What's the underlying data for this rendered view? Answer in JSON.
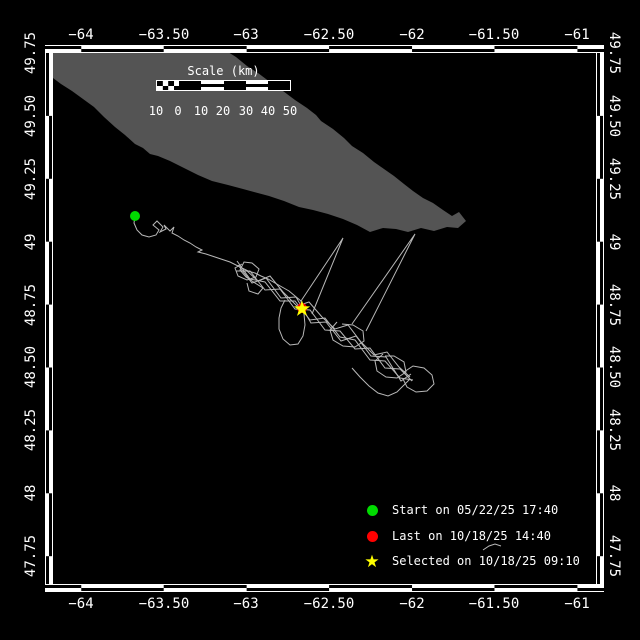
{
  "axes": {
    "top": [
      {
        "label": "−64",
        "x": 81
      },
      {
        "label": "−63.50",
        "x": 164
      },
      {
        "label": "−63",
        "x": 246
      },
      {
        "label": "−62.50",
        "x": 329
      },
      {
        "label": "−62",
        "x": 412
      },
      {
        "label": "−61.50",
        "x": 494
      },
      {
        "label": "−61",
        "x": 577
      }
    ],
    "bottom": [
      {
        "label": "−64",
        "x": 81
      },
      {
        "label": "−63.50",
        "x": 164
      },
      {
        "label": "−63",
        "x": 246
      },
      {
        "label": "−62.50",
        "x": 329
      },
      {
        "label": "−62",
        "x": 412
      },
      {
        "label": "−61.50",
        "x": 494
      },
      {
        "label": "−61",
        "x": 577
      }
    ],
    "left": [
      {
        "label": "49.75",
        "y": 53
      },
      {
        "label": "49.50",
        "y": 116
      },
      {
        "label": "49.25",
        "y": 179
      },
      {
        "label": "49",
        "y": 242
      },
      {
        "label": "48.75",
        "y": 305
      },
      {
        "label": "48.50",
        "y": 367
      },
      {
        "label": "48.25",
        "y": 430
      },
      {
        "label": "48",
        "y": 493
      },
      {
        "label": "47.75",
        "y": 556
      }
    ],
    "right": [
      {
        "label": "49.75",
        "y": 53
      },
      {
        "label": "49.50",
        "y": 116
      },
      {
        "label": "49.25",
        "y": 179
      },
      {
        "label": "49",
        "y": 242
      },
      {
        "label": "48.75",
        "y": 305
      },
      {
        "label": "48.50",
        "y": 367
      },
      {
        "label": "48.25",
        "y": 430
      },
      {
        "label": "48",
        "y": 493
      },
      {
        "label": "47.75",
        "y": 556
      }
    ]
  },
  "scale_bar": {
    "title": "Scale (km)",
    "labels": [
      {
        "label": "10",
        "x": 156
      },
      {
        "label": "0",
        "x": 178
      },
      {
        "label": "10",
        "x": 201
      },
      {
        "label": "20",
        "x": 223
      },
      {
        "label": "30",
        "x": 246
      },
      {
        "label": "40",
        "x": 268
      },
      {
        "label": "50",
        "x": 290
      }
    ]
  },
  "legend": {
    "items": [
      {
        "marker": "green-dot",
        "color": "#00db00",
        "label": "Start on 05/22/25 17:40",
        "y": 510
      },
      {
        "marker": "red-dot",
        "color": "#ff0000",
        "label": "Last on 10/18/25 14:40",
        "y": 536
      },
      {
        "marker": "yellow-star",
        "color": "#ffff00",
        "label": "Selected on 10/18/25 09:10",
        "y": 561
      }
    ]
  },
  "colors": {
    "background": "#000000",
    "frame": "#ffffff",
    "land": "#545454",
    "track": "#b8b8b8",
    "start": "#00db00",
    "last": "#ff0000",
    "selected": "#ffff00"
  },
  "map": {
    "island": {
      "points": [
        [
          53,
          52
        ],
        [
          228,
          52
        ],
        [
          236,
          57
        ],
        [
          247,
          66
        ],
        [
          258,
          73
        ],
        [
          270,
          82
        ],
        [
          283,
          91
        ],
        [
          295,
          100
        ],
        [
          307,
          108
        ],
        [
          316,
          115
        ],
        [
          321,
          121
        ],
        [
          333,
          129
        ],
        [
          344,
          138
        ],
        [
          352,
          146
        ],
        [
          363,
          153
        ],
        [
          374,
          162
        ],
        [
          384,
          169
        ],
        [
          394,
          176
        ],
        [
          404,
          184
        ],
        [
          413,
          191
        ],
        [
          423,
          198
        ],
        [
          433,
          203
        ],
        [
          443,
          210
        ],
        [
          452,
          216
        ],
        [
          459,
          212
        ],
        [
          466,
          221
        ],
        [
          458,
          228
        ],
        [
          447,
          227
        ],
        [
          434,
          231
        ],
        [
          421,
          228
        ],
        [
          408,
          232
        ],
        [
          396,
          229
        ],
        [
          383,
          228
        ],
        [
          370,
          232
        ],
        [
          357,
          225
        ],
        [
          343,
          219
        ],
        [
          328,
          214
        ],
        [
          313,
          210
        ],
        [
          299,
          207
        ],
        [
          284,
          201
        ],
        [
          269,
          196
        ],
        [
          254,
          192
        ],
        [
          243,
          189
        ],
        [
          228,
          185
        ],
        [
          212,
          181
        ],
        [
          198,
          175
        ],
        [
          184,
          168
        ],
        [
          170,
          161
        ],
        [
          158,
          156
        ],
        [
          150,
          154
        ],
        [
          143,
          148
        ],
        [
          135,
          144
        ],
        [
          125,
          135
        ],
        [
          115,
          127
        ],
        [
          104,
          117
        ],
        [
          94,
          107
        ],
        [
          83,
          99
        ],
        [
          72,
          91
        ],
        [
          61,
          84
        ],
        [
          53,
          78
        ]
      ]
    },
    "track": {
      "segments": [
        [
          [
            135,
            216
          ],
          [
            134,
            223
          ],
          [
            137,
            230
          ],
          [
            142,
            235
          ],
          [
            149,
            237
          ],
          [
            156,
            235
          ],
          [
            159,
            230
          ],
          [
            153,
            225
          ],
          [
            157,
            221
          ],
          [
            163,
            227
          ],
          [
            160,
            232
          ],
          [
            166,
            229
          ],
          [
            164,
            225
          ],
          [
            170,
            231
          ],
          [
            174,
            227
          ],
          [
            172,
            233
          ],
          [
            178,
            236
          ],
          [
            184,
            240
          ],
          [
            190,
            243
          ],
          [
            196,
            247
          ],
          [
            202,
            250
          ],
          [
            198,
            252
          ],
          [
            206,
            254
          ],
          [
            212,
            256
          ],
          [
            218,
            258
          ],
          [
            224,
            260
          ],
          [
            230,
            262
          ],
          [
            236,
            265
          ],
          [
            242,
            268
          ],
          [
            248,
            271
          ],
          [
            255,
            273
          ],
          [
            261,
            276
          ],
          [
            268,
            279
          ],
          [
            275,
            283
          ],
          [
            282,
            287
          ],
          [
            289,
            291
          ],
          [
            295,
            296
          ],
          [
            301,
            301
          ],
          [
            302,
            308
          ]
        ],
        [
          [
            237,
            261
          ],
          [
            250,
            279
          ],
          [
            265,
            282
          ],
          [
            280,
            301
          ],
          [
            295,
            301
          ],
          [
            310,
            320
          ],
          [
            325,
            318
          ],
          [
            340,
            337
          ],
          [
            355,
            340
          ],
          [
            370,
            360
          ],
          [
            385,
            361
          ],
          [
            400,
            378
          ],
          [
            413,
            380
          ]
        ],
        [
          [
            236,
            271
          ],
          [
            250,
            271
          ],
          [
            265,
            290
          ],
          [
            280,
            289
          ],
          [
            295,
            309
          ],
          [
            310,
            310
          ],
          [
            325,
            330
          ],
          [
            340,
            331
          ],
          [
            355,
            349
          ],
          [
            370,
            348
          ],
          [
            385,
            368
          ],
          [
            400,
            369
          ],
          [
            412,
            381
          ]
        ],
        [
          [
            238,
            265
          ],
          [
            252,
            283
          ],
          [
            266,
            278
          ],
          [
            281,
            298
          ],
          [
            296,
            297
          ],
          [
            311,
            323
          ],
          [
            326,
            322
          ],
          [
            341,
            341
          ],
          [
            356,
            336
          ],
          [
            371,
            356
          ],
          [
            386,
            357
          ],
          [
            401,
            381
          ],
          [
            411,
            374
          ]
        ],
        [
          [
            246,
            270
          ],
          [
            258,
            281
          ],
          [
            270,
            276
          ],
          [
            283,
            292
          ],
          [
            297,
            306
          ],
          [
            309,
            302
          ],
          [
            322,
            317
          ],
          [
            335,
            329
          ],
          [
            348,
            325
          ],
          [
            361,
            342
          ],
          [
            374,
            355
          ],
          [
            387,
            352
          ],
          [
            399,
            367
          ],
          [
            410,
            377
          ]
        ],
        [
          [
            352,
            368
          ],
          [
            360,
            377
          ],
          [
            369,
            386
          ],
          [
            378,
            393
          ],
          [
            388,
            396
          ],
          [
            397,
            392
          ],
          [
            404,
            385
          ],
          [
            410,
            379
          ]
        ],
        [
          [
            242,
            264
          ],
          [
            235,
            268
          ],
          [
            238,
            276
          ],
          [
            247,
            280
          ],
          [
            256,
            277
          ],
          [
            259,
            269
          ],
          [
            252,
            263
          ],
          [
            244,
            262
          ],
          [
            240,
            270
          ],
          [
            246,
            277
          ],
          [
            255,
            283
          ],
          [
            263,
            288
          ],
          [
            258,
            294
          ],
          [
            249,
            291
          ],
          [
            247,
            283
          ]
        ],
        [
          [
            285,
            300
          ],
          [
            281,
            308
          ],
          [
            279,
            318
          ],
          [
            279,
            329
          ],
          [
            283,
            339
          ],
          [
            290,
            345
          ],
          [
            298,
            344
          ],
          [
            303,
            336
          ],
          [
            305,
            325
          ],
          [
            304,
            314
          ],
          [
            302,
            306
          ]
        ],
        [
          [
            337,
            322
          ],
          [
            330,
            330
          ],
          [
            333,
            340
          ],
          [
            343,
            346
          ],
          [
            355,
            347
          ],
          [
            364,
            341
          ],
          [
            363,
            331
          ],
          [
            353,
            325
          ],
          [
            342,
            324
          ]
        ],
        [
          [
            383,
            354
          ],
          [
            375,
            361
          ],
          [
            377,
            371
          ],
          [
            386,
            377
          ],
          [
            397,
            378
          ],
          [
            406,
            372
          ],
          [
            404,
            362
          ],
          [
            394,
            356
          ],
          [
            385,
            356
          ]
        ],
        [
          [
            404,
            372
          ],
          [
            413,
            366
          ],
          [
            424,
            368
          ],
          [
            432,
            375
          ],
          [
            434,
            384
          ],
          [
            427,
            391
          ],
          [
            416,
            392
          ],
          [
            407,
            387
          ],
          [
            403,
            379
          ]
        ],
        [
          [
            301,
            301
          ],
          [
            343,
            238
          ],
          [
            312,
            314
          ]
        ],
        [
          [
            352,
            324
          ],
          [
            415,
            234
          ],
          [
            366,
            331
          ]
        ],
        [
          [
            483,
            550
          ],
          [
            489,
            546
          ],
          [
            495,
            544
          ],
          [
            501,
            546
          ]
        ]
      ]
    },
    "markers": {
      "start": {
        "x": 135,
        "y": 216
      },
      "last": {
        "x": 302,
        "y": 308
      },
      "selected": {
        "x": 302,
        "y": 309
      }
    }
  }
}
